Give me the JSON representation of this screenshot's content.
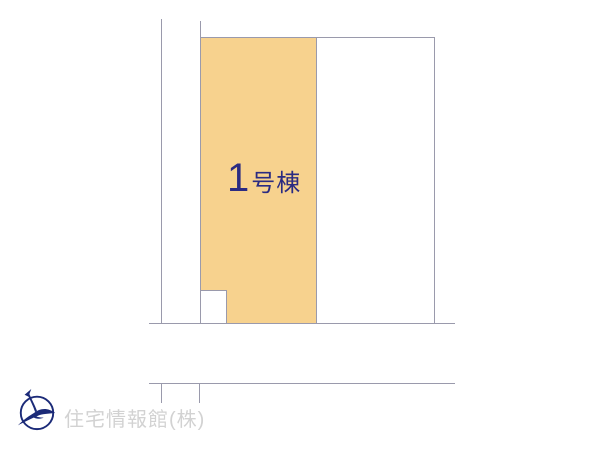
{
  "plan": {
    "building_label": {
      "number": "1",
      "suffix": "号棟"
    }
  },
  "footer": {
    "company_name": "住宅情報館(株)"
  },
  "icons": {
    "logo": "bird-in-circle-logo-icon"
  },
  "colors": {
    "background": "#ffffff",
    "parcel_fill": "#f7d28e",
    "line": "#9a9aac",
    "label_text": "#2b2b82",
    "logo": "#1b2a78",
    "company_text": "#d2d2d2"
  }
}
